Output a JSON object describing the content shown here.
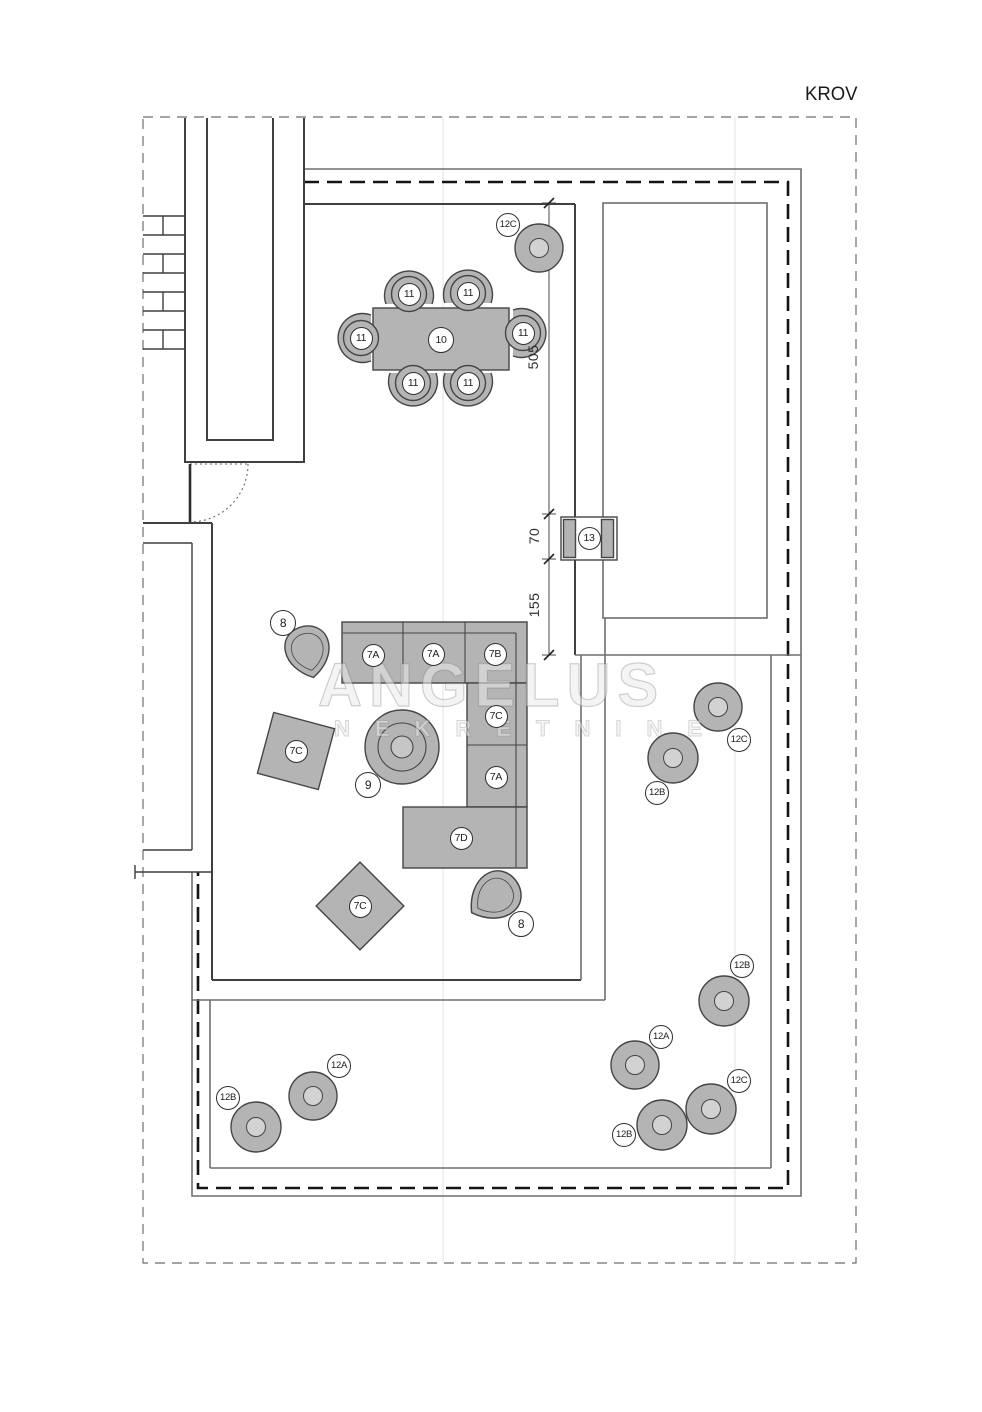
{
  "page_title": "KROV",
  "watermark": {
    "line1": "ANGELUS",
    "line2": "NEKRETNINE"
  },
  "dimensions": [
    {
      "text": "505",
      "x": 533,
      "y": 357
    },
    {
      "text": "70",
      "x": 534,
      "y": 536
    },
    {
      "text": "155",
      "x": 534,
      "y": 605
    }
  ],
  "furniture_labels": [
    {
      "text": "12C",
      "x": 508,
      "y": 225
    },
    {
      "text": "11",
      "x": 409,
      "y": 294
    },
    {
      "text": "11",
      "x": 468,
      "y": 293
    },
    {
      "text": "11",
      "x": 361,
      "y": 338
    },
    {
      "text": "10",
      "x": 441,
      "y": 340,
      "d": 26
    },
    {
      "text": "11",
      "x": 523,
      "y": 333
    },
    {
      "text": "11",
      "x": 413,
      "y": 383
    },
    {
      "text": "11",
      "x": 468,
      "y": 383
    },
    {
      "text": "13",
      "x": 589,
      "y": 538
    },
    {
      "text": "8",
      "x": 283,
      "y": 623,
      "d": 26
    },
    {
      "text": "7A",
      "x": 373,
      "y": 655
    },
    {
      "text": "7A",
      "x": 433,
      "y": 654
    },
    {
      "text": "7B",
      "x": 495,
      "y": 654
    },
    {
      "text": "7C",
      "x": 496,
      "y": 716
    },
    {
      "text": "7C",
      "x": 296,
      "y": 751
    },
    {
      "text": "9",
      "x": 368,
      "y": 785,
      "d": 26
    },
    {
      "text": "7A",
      "x": 496,
      "y": 777
    },
    {
      "text": "7D",
      "x": 461,
      "y": 838
    },
    {
      "text": "7C",
      "x": 360,
      "y": 906
    },
    {
      "text": "8",
      "x": 521,
      "y": 924,
      "d": 26
    },
    {
      "text": "12C",
      "x": 739,
      "y": 740
    },
    {
      "text": "12B",
      "x": 657,
      "y": 793
    },
    {
      "text": "12B",
      "x": 742,
      "y": 966
    },
    {
      "text": "12A",
      "x": 661,
      "y": 1037
    },
    {
      "text": "12C",
      "x": 739,
      "y": 1081
    },
    {
      "text": "12B",
      "x": 624,
      "y": 1135
    },
    {
      "text": "12A",
      "x": 339,
      "y": 1066
    },
    {
      "text": "12B",
      "x": 228,
      "y": 1098
    }
  ],
  "colors": {
    "furniture_fill": "#b4b4b4",
    "wall_line": "#3f3f3f",
    "boundary_line": "#6e6e6e",
    "roof_dash": "#141414",
    "label_border": "#2f2f2f",
    "watermark": "#e7e7e7"
  }
}
